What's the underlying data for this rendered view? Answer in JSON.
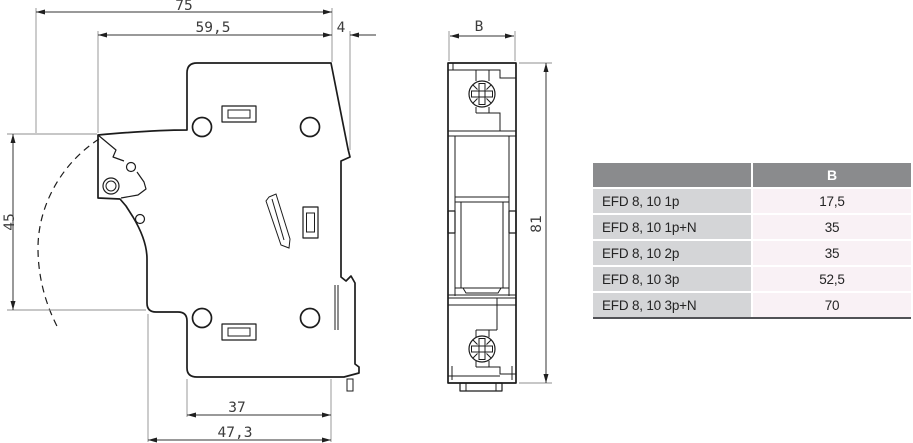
{
  "drawing": {
    "side_view": {
      "dims": {
        "total_depth": "75",
        "body_depth": "59,5",
        "rail_offset": "4",
        "front_height": "45",
        "base_depth": "37",
        "base_total_depth": "47,3"
      }
    },
    "front_view": {
      "dims": {
        "width": "B",
        "height": "81"
      }
    }
  },
  "table": {
    "header_label": "B",
    "rows": [
      {
        "model": "EFD 8, 10 1p",
        "b": "17,5"
      },
      {
        "model": "EFD 8, 10 1p+N",
        "b": "35"
      },
      {
        "model": "EFD 8, 10 2p",
        "b": "35"
      },
      {
        "model": "EFD 8, 10 3p",
        "b": "52,5"
      },
      {
        "model": "EFD 8, 10 3p+N",
        "b": "70"
      }
    ],
    "colors": {
      "header_bg": "#8a8b8d",
      "header_text": "#ffffff",
      "model_bg": "#d4d5d7",
      "value_bg": "#f9f1f5",
      "bottom_border": "#515256"
    }
  }
}
